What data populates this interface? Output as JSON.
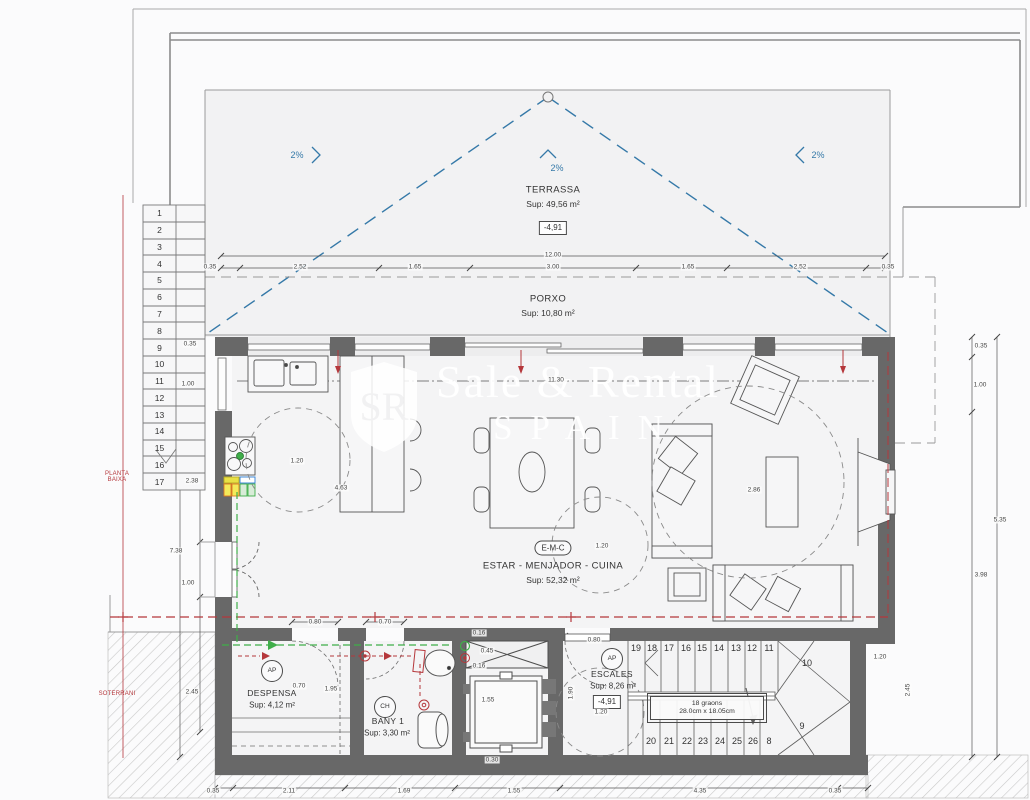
{
  "colors": {
    "wall": "#686868",
    "drawing_line": "#5e5e5e",
    "slope_blue": "#3579a8",
    "section_red": "#b5373b",
    "vent_green": "#3fae49",
    "bin_yellow": "#e8e045",
    "bin_blue": "#2f7fd6",
    "paper": "#fbfbfc",
    "floor": "#f3f3f4"
  },
  "watermark": {
    "line1": "Sale & Rental",
    "line2": "SPAIN",
    "monogram": "SR"
  },
  "levels": {
    "upper_l1": "PLANTA",
    "upper_l2": "BAIXA",
    "lower": "SOTERRANI"
  },
  "rooms": {
    "terrassa": {
      "name": "TERRASSA",
      "area": "Sup: 49,56 m²",
      "level": "-4,91"
    },
    "porxo": {
      "name": "PORXO",
      "area": "Sup: 10,80 m²"
    },
    "emc": {
      "code": "E-M-C",
      "name": "ESTAR - MENJADOR - CUINA",
      "area": "Sup: 52,32 m²"
    },
    "despensa": {
      "code": "AP",
      "name": "DESPENSA",
      "area": "Sup: 4,12 m²"
    },
    "bany": {
      "code": "CH",
      "name": "BANY 1",
      "area": "Sup: 3,30 m²"
    },
    "escales": {
      "code": "AP",
      "name": "ESCALES",
      "area": "Sup: 8,26 m²",
      "level": "-4,91",
      "steps_note_1": "18 graons",
      "steps_note_2": "28.0cm x 18.05cm"
    }
  },
  "slopes": [
    {
      "t": "2%",
      "x": 297,
      "y": 155
    },
    {
      "t": "2%",
      "x": 557,
      "y": 168
    },
    {
      "t": "2%",
      "x": 818,
      "y": 155
    }
  ],
  "left_flight": [
    "1",
    "2",
    "3",
    "4",
    "5",
    "6",
    "7",
    "8",
    "9",
    "10",
    "11",
    "12",
    "13",
    "14",
    "15",
    "16",
    "17"
  ],
  "lower_flight": [
    {
      "t": "19",
      "x": 636,
      "y": 648
    },
    {
      "t": "18",
      "x": 652,
      "y": 648
    },
    {
      "t": "17",
      "x": 669,
      "y": 648
    },
    {
      "t": "16",
      "x": 686,
      "y": 648
    },
    {
      "t": "15",
      "x": 702,
      "y": 648
    },
    {
      "t": "14",
      "x": 719,
      "y": 648
    },
    {
      "t": "13",
      "x": 736,
      "y": 648
    },
    {
      "t": "12",
      "x": 752,
      "y": 648
    },
    {
      "t": "11",
      "x": 769,
      "y": 648
    },
    {
      "t": "10",
      "x": 807,
      "y": 663
    },
    {
      "t": "9",
      "x": 802,
      "y": 726
    },
    {
      "t": "20",
      "x": 651,
      "y": 741
    },
    {
      "t": "21",
      "x": 669,
      "y": 741
    },
    {
      "t": "22",
      "x": 687,
      "y": 741
    },
    {
      "t": "23",
      "x": 703,
      "y": 741
    },
    {
      "t": "24",
      "x": 720,
      "y": 741
    },
    {
      "t": "25",
      "x": 737,
      "y": 741
    },
    {
      "t": "26",
      "x": 753,
      "y": 741
    },
    {
      "t": "8",
      "x": 769,
      "y": 741
    }
  ],
  "dim_labels": [
    {
      "t": "12.00",
      "x": 553,
      "y": 255
    },
    {
      "t": "0.35",
      "x": 210,
      "y": 267
    },
    {
      "t": "2.52",
      "x": 300,
      "y": 267
    },
    {
      "t": "1.65",
      "x": 415,
      "y": 267
    },
    {
      "t": "3.00",
      "x": 553,
      "y": 267
    },
    {
      "t": "1.65",
      "x": 688,
      "y": 267
    },
    {
      "t": "2.52",
      "x": 800,
      "y": 267
    },
    {
      "t": "0.35",
      "x": 888,
      "y": 267
    },
    {
      "t": "11.30",
      "x": 556,
      "y": 380
    },
    {
      "t": "0.35",
      "x": 190,
      "y": 344
    },
    {
      "t": "1.00",
      "x": 188,
      "y": 384
    },
    {
      "t": "2.38",
      "x": 192,
      "y": 481
    },
    {
      "t": "7.38",
      "x": 176,
      "y": 551
    },
    {
      "t": "1.00",
      "x": 188,
      "y": 583
    },
    {
      "t": "2.45",
      "x": 192,
      "y": 692
    },
    {
      "t": "0.35",
      "x": 981,
      "y": 346
    },
    {
      "t": "1.00",
      "x": 980,
      "y": 385
    },
    {
      "t": "5.35",
      "x": 1000,
      "y": 520
    },
    {
      "t": "3.98",
      "x": 981,
      "y": 575
    },
    {
      "t": "0.35",
      "x": 213,
      "y": 791
    },
    {
      "t": "2.11",
      "x": 289,
      "y": 791
    },
    {
      "t": "1.69",
      "x": 404,
      "y": 791
    },
    {
      "t": "1.55",
      "x": 514,
      "y": 791
    },
    {
      "t": "4.35",
      "x": 700,
      "y": 791
    },
    {
      "t": "0.35",
      "x": 835,
      "y": 791
    },
    {
      "t": "1.20",
      "x": 297,
      "y": 461
    },
    {
      "t": "4.63",
      "x": 341,
      "y": 488
    },
    {
      "t": "1.20",
      "x": 602,
      "y": 546
    },
    {
      "t": "2.86",
      "x": 754,
      "y": 490
    },
    {
      "t": "0.80",
      "x": 315,
      "y": 622
    },
    {
      "t": "0.70",
      "x": 385,
      "y": 622
    },
    {
      "t": "0.70",
      "x": 299,
      "y": 686
    },
    {
      "t": "1.95",
      "x": 331,
      "y": 689
    },
    {
      "t": "0.16",
      "x": 479,
      "y": 633
    },
    {
      "t": "0.45",
      "x": 487,
      "y": 651
    },
    {
      "t": "0.16",
      "x": 479,
      "y": 666
    },
    {
      "t": "1.55",
      "x": 488,
      "y": 700
    },
    {
      "t": "1.90",
      "x": 571,
      "y": 693,
      "rot": -90
    },
    {
      "t": "0.80",
      "x": 594,
      "y": 640
    },
    {
      "t": "1.20",
      "x": 601,
      "y": 712
    },
    {
      "t": "0.30",
      "x": 492,
      "y": 760
    },
    {
      "t": "1.20",
      "x": 880,
      "y": 657
    },
    {
      "t": "2.45",
      "x": 908,
      "y": 690,
      "rot": -90
    }
  ]
}
